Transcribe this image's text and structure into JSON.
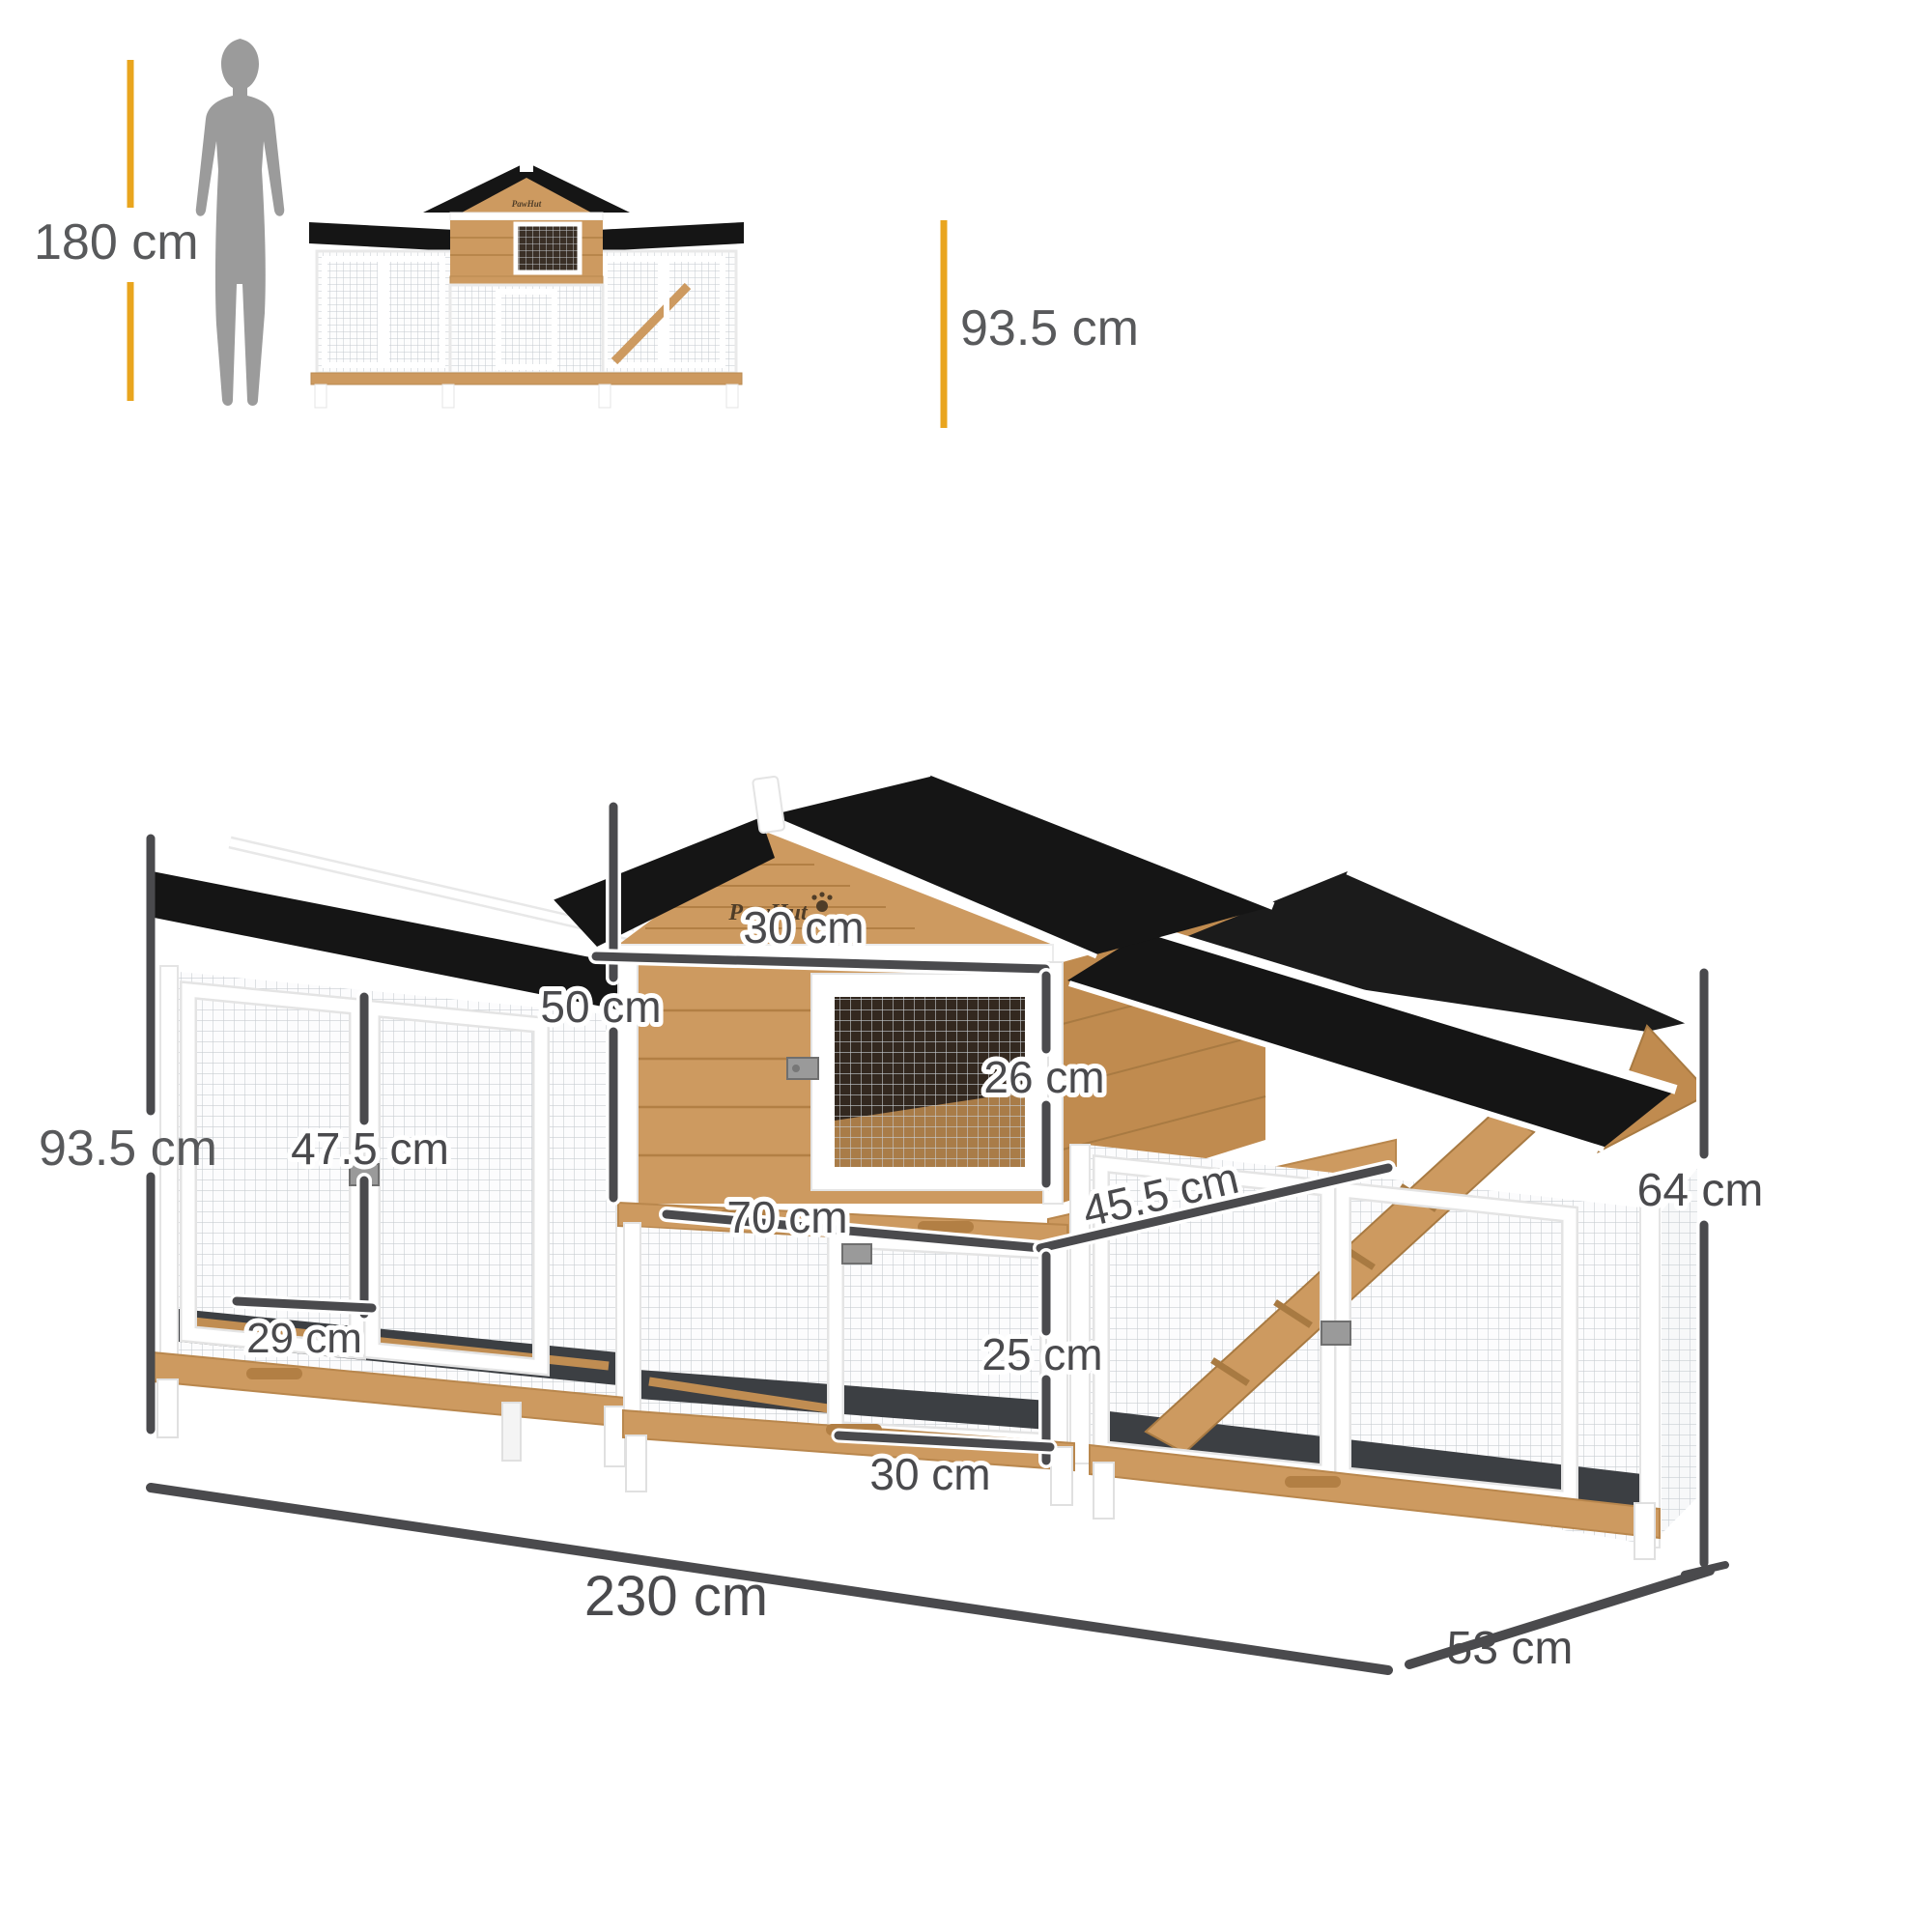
{
  "brand": "PawHut",
  "scale_figure": {
    "person_height": "180 cm"
  },
  "front_view": {
    "total_height": "93.5 cm"
  },
  "annotations": {
    "main_height": "93.5 cm",
    "house_height": "50 cm",
    "hatch_width": "30 cm",
    "hatch_height": "26 cm",
    "left_door_height": "47.5 cm",
    "left_door_width": "29 cm",
    "run_width": "70 cm",
    "platform_depth": "45.5 cm",
    "lower_hatch_height": "25 cm",
    "lower_hatch_width": "30 cm",
    "total_width": "230 cm",
    "total_depth": "53 cm",
    "right_wing_height": "64 cm"
  },
  "colors": {
    "accent_yellow": "#E9A51E",
    "dimension_line": "#4A4A4D",
    "label_text": "#4A4A4D",
    "secondary_text": "#58595B",
    "roof_black": "#151515",
    "wood": "#CD9A60",
    "wood_dark": "#B27F44",
    "frame_white": "#FFFFFF",
    "silhouette_gray": "#9B9B9B"
  }
}
